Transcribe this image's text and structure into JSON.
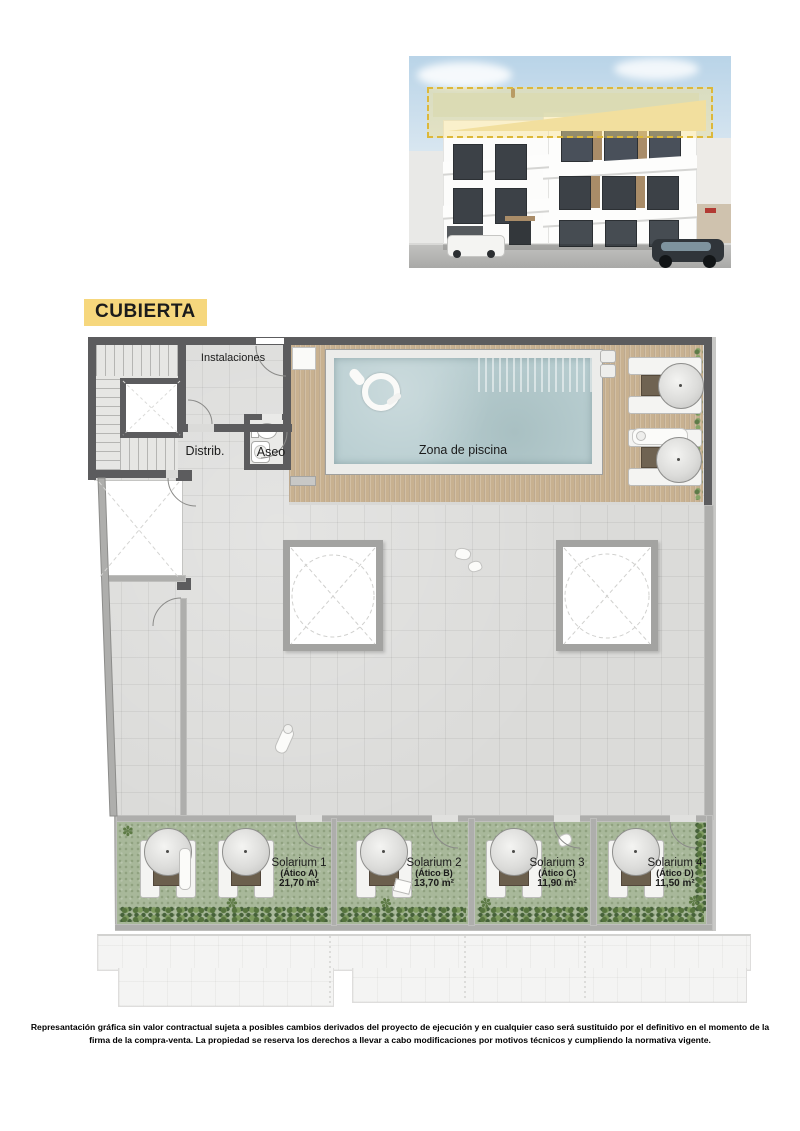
{
  "header": {
    "title": "CUBIERTA"
  },
  "plan": {
    "rooms": {
      "installations_label": "Instalaciones",
      "distributor_label": "Distrib.",
      "toilet_label": "Aseo",
      "pool_label": "Zona de piscina"
    },
    "solariums": [
      {
        "name": "Solarium 1",
        "unit": "(Ático A)",
        "area": "21,70 m²"
      },
      {
        "name": "Solarium 2",
        "unit": "(Ático B)",
        "area": "13,70 m²"
      },
      {
        "name": "Solarium 3",
        "unit": "(Ático C)",
        "area": "11,90 m²"
      },
      {
        "name": "Solarium 4",
        "unit": "(Ático D)",
        "area": "11,50 m²"
      }
    ]
  },
  "footer": {
    "disclaimer_line1": "Represantación gráfica sin valor contractual sujeta a posibles cambios derivados del proyecto de ejecución y en cualquier caso será sustituido por el definitivo en el momento de la",
    "disclaimer_line2": "firma de la compra-venta. La propiedad se reserva los derechos a llevar a cabo modificaciones por motivos técnicos y cumpliendo la normativa vigente."
  },
  "icons": {
    "plant_glyph": "✽"
  },
  "colors": {
    "highlight_yellow": "#f6d77d",
    "wall_dark": "#5c5c5e",
    "wall_light": "#aeaeac",
    "deck_wood": "#c8b190",
    "pool_water": "#b9ced1",
    "grass_green": "#a8b89a",
    "tile_gray": "#dbdbd9"
  }
}
